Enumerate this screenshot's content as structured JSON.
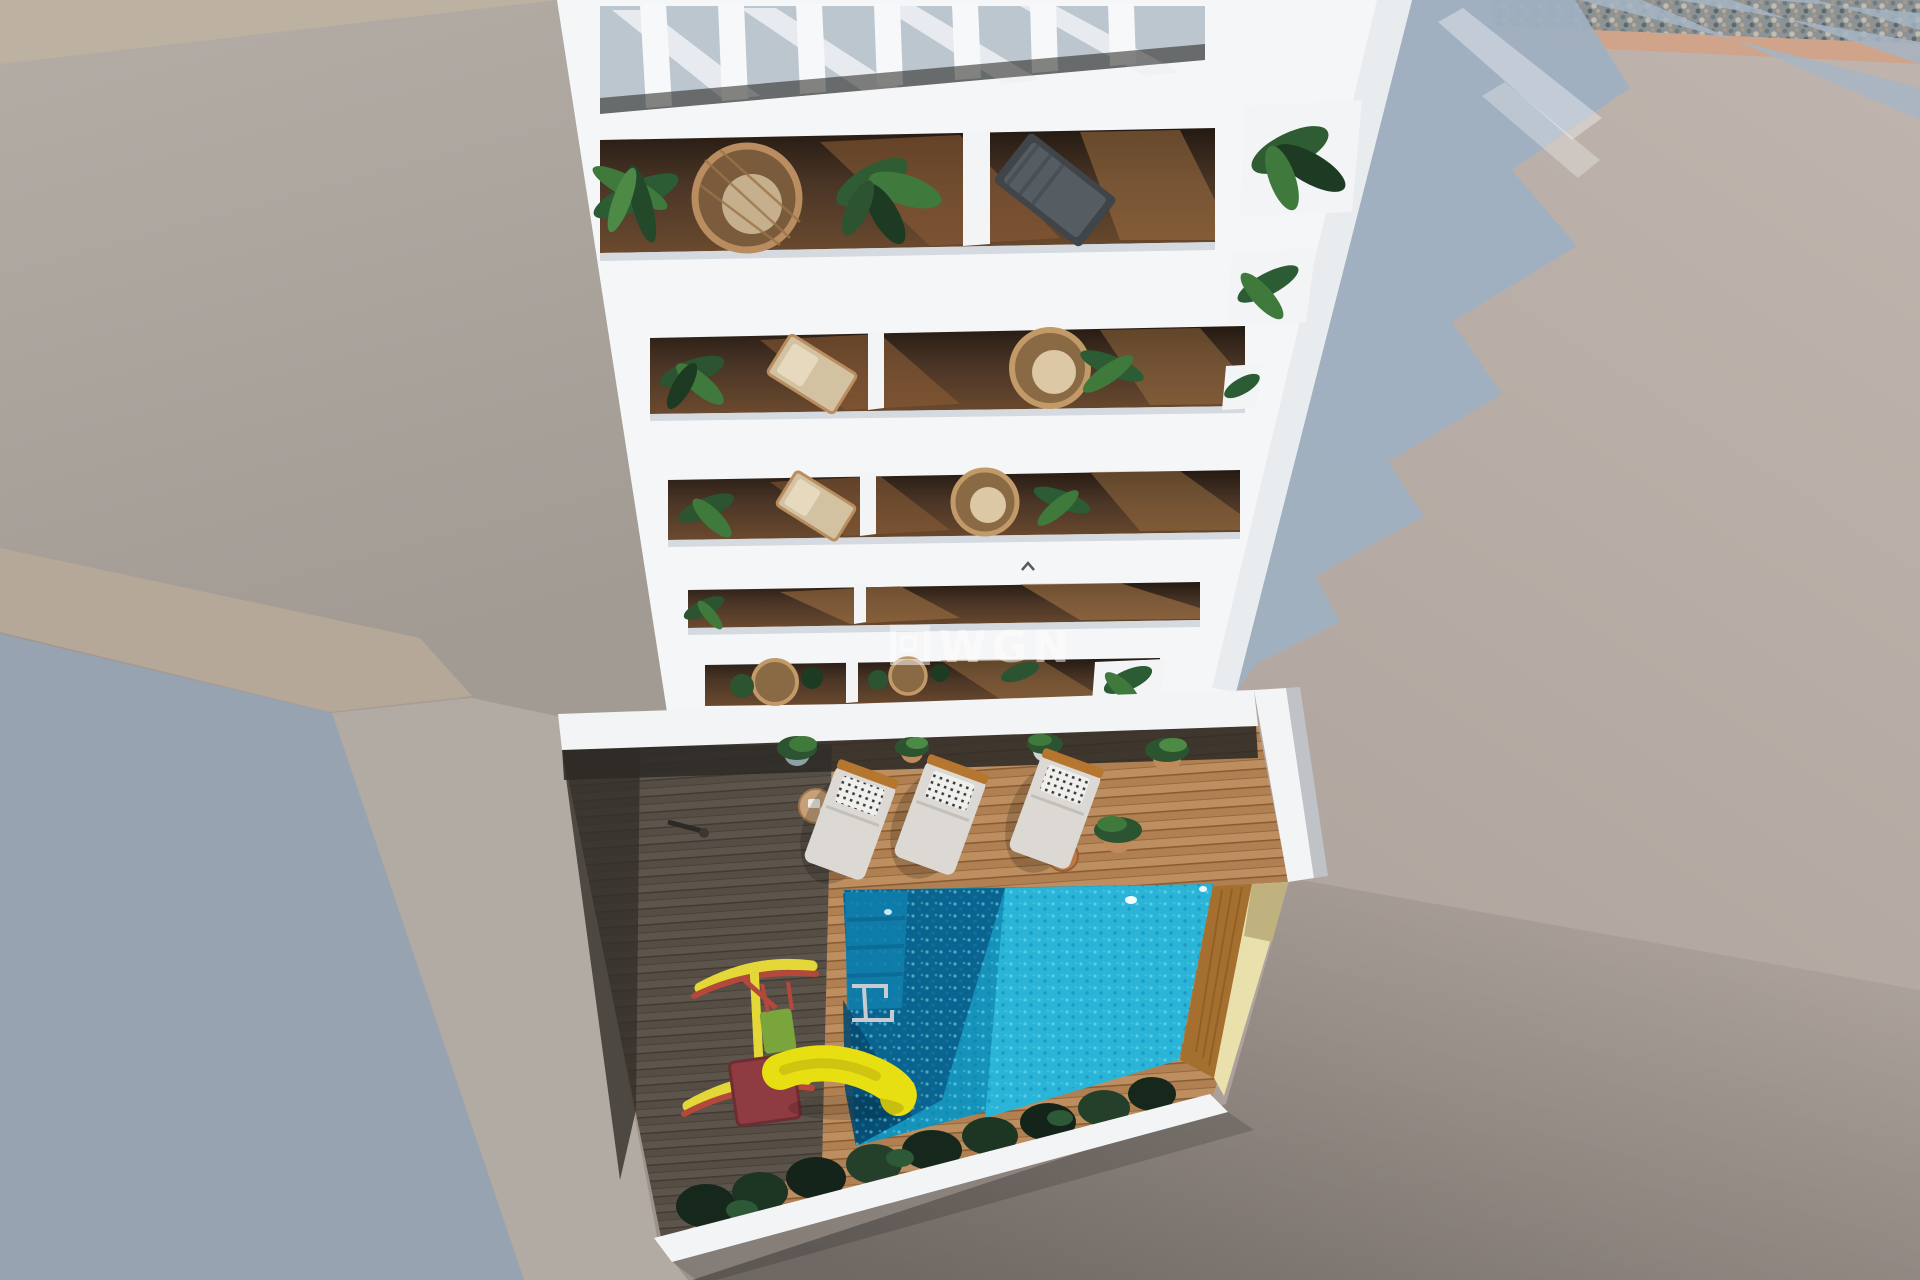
{
  "scene": {
    "description": "Aerial 3D architectural render: white apartment tower with rooftop pergola, plant-filled balconies, ground-floor courtyard with swimming pool, wooden deck, three sun loungers and a children's playground with yellow slide",
    "watermark": {
      "icon": "wgn-frame-icon",
      "text": "WGN"
    }
  },
  "colors": {
    "building_white": "#f5f6f8",
    "wall_tint": "#e8ecef",
    "shadow_blue": "#9fb0c1",
    "left_shadow": "#98a3b1",
    "rooftop_light": "#bdb2ab",
    "left_wall": "#b2aba4",
    "warm_strip": "#bdb1a2",
    "beige_plane": "#b6a999",
    "gravel": "#8d9294",
    "tan_strip": "#cfa48a",
    "deck_light": "#b08052",
    "deck_dark": "#564e45",
    "interior_wood": "#4a3526",
    "pool_light": "#2ab5d8",
    "pool_mid": "#1593bb",
    "pool_shadow": "#0b5e8b",
    "pool_deep": "#084a70",
    "sand": "#e9e0ac",
    "bush_green": "#1a2e20",
    "plant_green": "#2f5c33",
    "wicker": "#b98d5f",
    "lounger_body": "#dcd9d4",
    "lounger_wood": "#b5772f",
    "slide_yellow": "#e8df12",
    "slide_red": "#8e3b42",
    "swing_yellow": "#e3d838",
    "swing_red": "#b5483a",
    "watermark_white": "#ffffff"
  }
}
